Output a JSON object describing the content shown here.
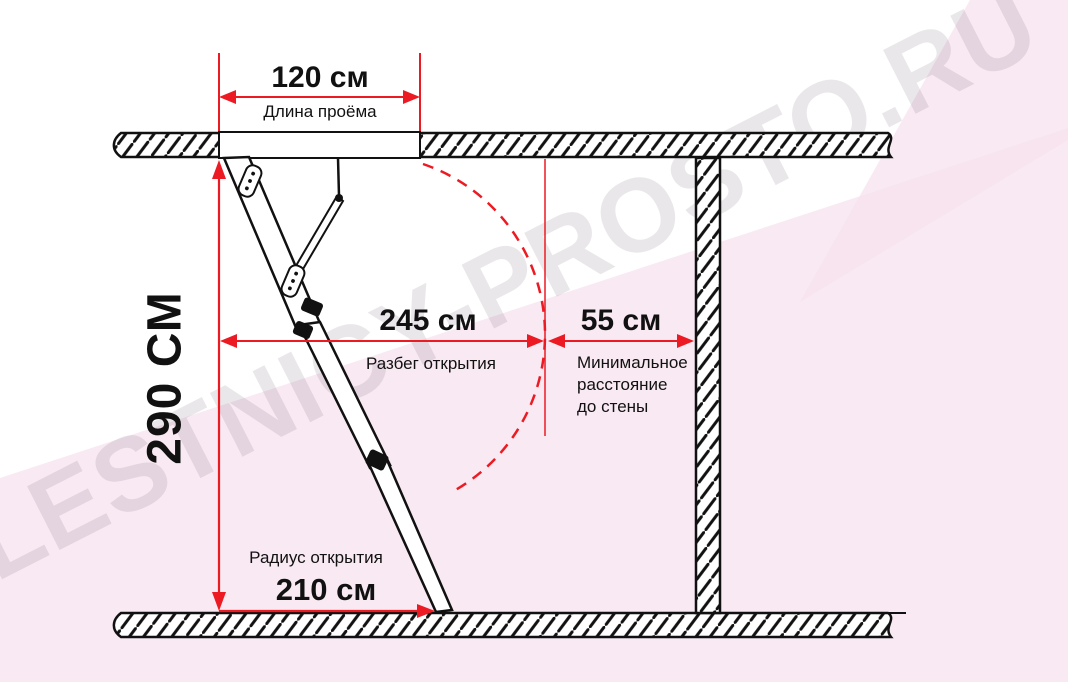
{
  "watermark": {
    "text": "LESTNICY-PROSTO.RU"
  },
  "dimensions": {
    "opening_width": {
      "value": "120 см",
      "label": "Длина проёма"
    },
    "ceiling_height": {
      "value": "290 СМ"
    },
    "opening_run": {
      "value": "245 см",
      "label": "Разбег открытия"
    },
    "wall_distance": {
      "value": "55 см",
      "label_lines": [
        "Минимальное",
        "расстояние",
        "до стены"
      ]
    },
    "opening_radius": {
      "value": "210 см",
      "label": "Радиус открытия"
    }
  },
  "colors": {
    "dimension_red": "#ec1b23",
    "line_black": "#111111",
    "pink_band": "#f6e3ee",
    "watermark_gray": "#80707e"
  }
}
